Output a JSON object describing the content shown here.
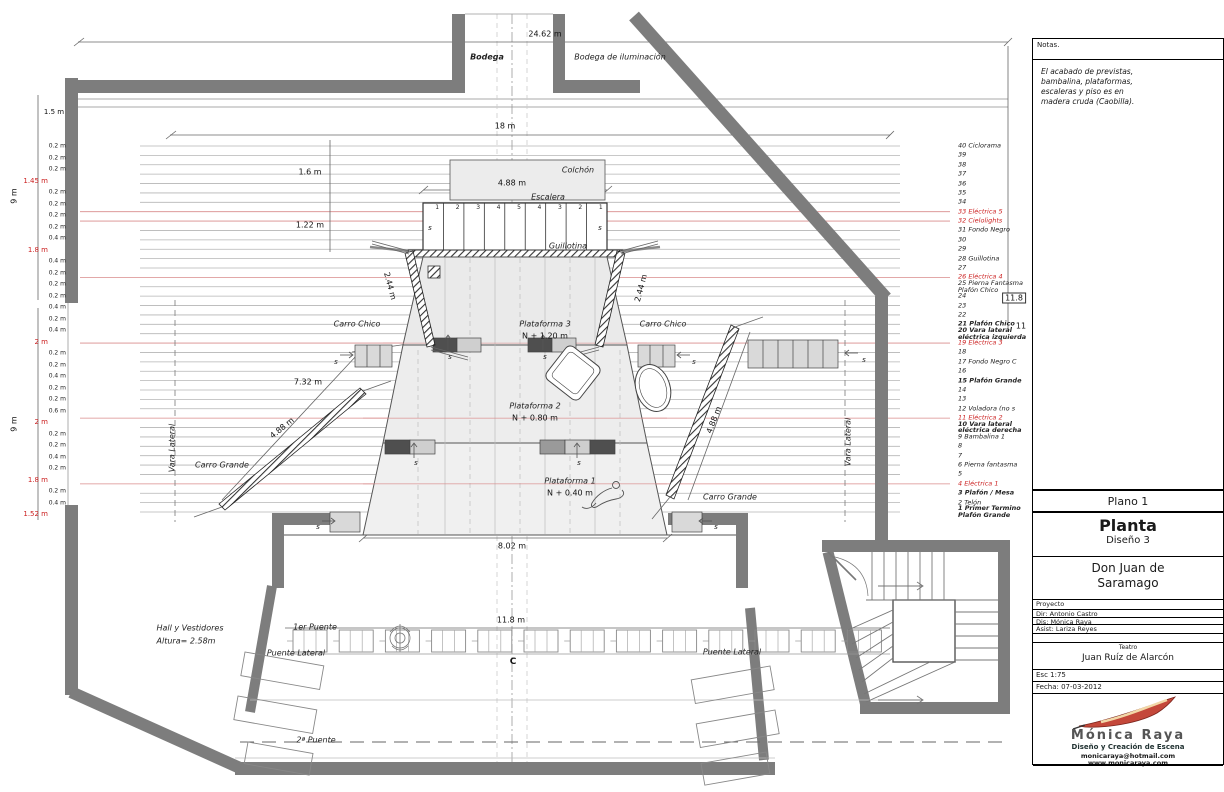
{
  "notes": {
    "title": "Notas.",
    "body": "El acabado de previstas,\nbambalina, plataformas,\nescaleras y piso es en\nmadera cruda (Caobilla)."
  },
  "title_block": {
    "plano": "Plano 1",
    "title": "Planta",
    "subtitle": "Diseño 3",
    "show": "Don Juan de\nSaramago",
    "proyecto": "Proyecto",
    "dir": "Dir: Antonio Castro",
    "dis": "Dis: Mónica Raya",
    "asist": "Asist: Lariza Reyes",
    "teatro_label": "Teatro",
    "teatro": "Juan Ruíz de Alarcón",
    "esc": "Esc 1:75",
    "fecha": "Fecha: 07-03-2012",
    "studio": "Mónica Raya",
    "studio_sub": "Diseño y Creación de Escena",
    "email": "monicaraya@hotmail.com",
    "web": "www.monicaraya.com"
  },
  "stage": {
    "bodega": "Bodega",
    "bodega_ilum": "Bodega de iluminación",
    "colchon": "Colchón",
    "escalera": "Escalera",
    "guillotina": "Guillotina",
    "plataforma3": "Plataforma 3",
    "plataforma3_n": "N + 1.20 m",
    "plataforma2": "Plataforma 2",
    "plataforma2_n": "N + 0.80 m",
    "plataforma1": "Plataforma 1",
    "plataforma1_n": "N + 0.40 m",
    "carro_chico": "Carro Chico",
    "carro_grande": "Carro Grande",
    "vara_lateral": "Vara Lateral",
    "s_mark": "s",
    "stair_numbers": [
      "1",
      "2",
      "3",
      "4",
      "5",
      "4",
      "3",
      "2",
      "1"
    ]
  },
  "audience": {
    "primer_puente": "1er Puente",
    "segundo_puente": "2ª Puente",
    "puente_lateral_left": "Puente Lateral",
    "puente_lateral_right": "Puente Lateral",
    "hall": "Hall y Vestidores",
    "hall_altura": "Altura= 2.58m",
    "centerline": "C"
  },
  "dims": {
    "top_width": "24.62 m",
    "battens_width": "18 m",
    "d_1_6": "1.6 m",
    "colchon_width": "4.88 m",
    "d_1_22": "1.22 m",
    "carro_chico_left": "2.44 m",
    "carro_chico_right": "2.44 m",
    "d_7_32": "7.32 m",
    "carro_grande_left": "4.88 m",
    "carro_grande_right": "4.88 m",
    "plataforma1_width": "8.02 m",
    "bridge_width": "11.8 m",
    "left_9_upper": "9 m",
    "left_9_lower": "9 m",
    "d_1_5": "1.5 m",
    "right_11_8": "11.8",
    "right_11": "11"
  },
  "varas": {
    "items": [
      {
        "n": 40,
        "label": "Ciclorama",
        "red": false,
        "bold": false
      },
      {
        "n": 39,
        "label": "",
        "red": false,
        "bold": false
      },
      {
        "n": 38,
        "label": "",
        "red": false,
        "bold": false
      },
      {
        "n": 37,
        "label": "",
        "red": false,
        "bold": false
      },
      {
        "n": 36,
        "label": "",
        "red": false,
        "bold": false
      },
      {
        "n": 35,
        "label": "",
        "red": false,
        "bold": false
      },
      {
        "n": 34,
        "label": "",
        "red": false,
        "bold": false
      },
      {
        "n": 33,
        "label": "Eléctrica 5",
        "red": true,
        "bold": false
      },
      {
        "n": 32,
        "label": "Cielolights",
        "red": true,
        "bold": false
      },
      {
        "n": 31,
        "label": "Fondo Negro",
        "red": false,
        "bold": false
      },
      {
        "n": 30,
        "label": "",
        "red": false,
        "bold": false
      },
      {
        "n": 29,
        "label": "",
        "red": false,
        "bold": false
      },
      {
        "n": 28,
        "label": "Guillotina",
        "red": false,
        "bold": false
      },
      {
        "n": 27,
        "label": "",
        "red": false,
        "bold": false
      },
      {
        "n": 26,
        "label": "Eléctrica 4",
        "red": true,
        "bold": false
      },
      {
        "n": 25,
        "label": "Pierna Fantasma Plafón Chico",
        "red": false,
        "bold": false
      },
      {
        "n": 24,
        "label": "",
        "red": false,
        "bold": false
      },
      {
        "n": 23,
        "label": "",
        "red": false,
        "bold": false
      },
      {
        "n": 22,
        "label": "",
        "red": false,
        "bold": false
      },
      {
        "n": 21,
        "label": "Plafón Chico",
        "red": false,
        "bold": true
      },
      {
        "n": 20,
        "label": "Vara lateral eléctrica izquierda",
        "red": false,
        "bold": true
      },
      {
        "n": 19,
        "label": "Eléctrica 3",
        "red": true,
        "bold": false
      },
      {
        "n": 18,
        "label": "",
        "red": false,
        "bold": false
      },
      {
        "n": 17,
        "label": "Fondo Negro C",
        "red": false,
        "bold": false
      },
      {
        "n": 16,
        "label": "",
        "red": false,
        "bold": false
      },
      {
        "n": 15,
        "label": "Plafón Grande",
        "red": false,
        "bold": true
      },
      {
        "n": 14,
        "label": "",
        "red": false,
        "bold": false
      },
      {
        "n": 13,
        "label": "",
        "red": false,
        "bold": false
      },
      {
        "n": 12,
        "label": "Voladora (no s",
        "red": false,
        "bold": false
      },
      {
        "n": 11,
        "label": "Eléctrica 2",
        "red": true,
        "bold": false
      },
      {
        "n": 10,
        "label": "Vara lateral eléctrica derecha",
        "red": false,
        "bold": true
      },
      {
        "n": 9,
        "label": "Bambalina 1",
        "red": false,
        "bold": false
      },
      {
        "n": 8,
        "label": "",
        "red": false,
        "bold": false
      },
      {
        "n": 7,
        "label": "",
        "red": false,
        "bold": false
      },
      {
        "n": 6,
        "label": "Pierna fantasma",
        "red": false,
        "bold": false
      },
      {
        "n": 5,
        "label": "",
        "red": false,
        "bold": false
      },
      {
        "n": 4,
        "label": "Eléctrica 1",
        "red": true,
        "bold": false
      },
      {
        "n": 3,
        "label": "Plafón / Mesa",
        "red": false,
        "bold": true
      },
      {
        "n": 2,
        "label": "Telón",
        "red": false,
        "bold": false
      },
      {
        "n": 1,
        "label": "Primer Termino Plafón Grande",
        "red": false,
        "bold": true
      }
    ]
  },
  "left_dims": [
    {
      "v": "0.2 m",
      "red": false
    },
    {
      "v": "0.2 m",
      "red": false
    },
    {
      "v": "0.2 m",
      "red": false
    },
    {
      "v": "1.45 m",
      "red": true
    },
    {
      "v": "0.2 m",
      "red": false
    },
    {
      "v": "0.2 m",
      "red": false
    },
    {
      "v": "0.2 m",
      "red": false
    },
    {
      "v": "0.2 m",
      "red": false
    },
    {
      "v": "0.4 m",
      "red": false
    },
    {
      "v": "1.8 m",
      "red": true
    },
    {
      "v": "0.4 m",
      "red": false
    },
    {
      "v": "0.2 m",
      "red": false
    },
    {
      "v": "0.2 m",
      "red": false
    },
    {
      "v": "0.2 m",
      "red": false
    },
    {
      "v": "0.4 m",
      "red": false
    },
    {
      "v": "0.2 m",
      "red": false
    },
    {
      "v": "0.4 m",
      "red": false
    },
    {
      "v": "2 m",
      "red": true
    },
    {
      "v": "0.2 m",
      "red": false
    },
    {
      "v": "0.2 m",
      "red": false
    },
    {
      "v": "0.4 m",
      "red": false
    },
    {
      "v": "0.2 m",
      "red": false
    },
    {
      "v": "0.2 m",
      "red": false
    },
    {
      "v": "0.6 m",
      "red": false
    },
    {
      "v": "2 m",
      "red": true
    },
    {
      "v": "0.2 m",
      "red": false
    },
    {
      "v": "0.2 m",
      "red": false
    },
    {
      "v": "0.4 m",
      "red": false
    },
    {
      "v": "0.2 m",
      "red": false
    },
    {
      "v": "1.8 m",
      "red": true
    },
    {
      "v": "0.2 m",
      "red": false
    },
    {
      "v": "0.4 m",
      "red": false
    },
    {
      "v": "1.52 m",
      "red": true
    }
  ],
  "colors": {
    "wall": "#7d7d7d",
    "electric_line": "#d98b8b",
    "batten_line": "#b5b5b5",
    "platform_fill": "#ebebeb"
  }
}
